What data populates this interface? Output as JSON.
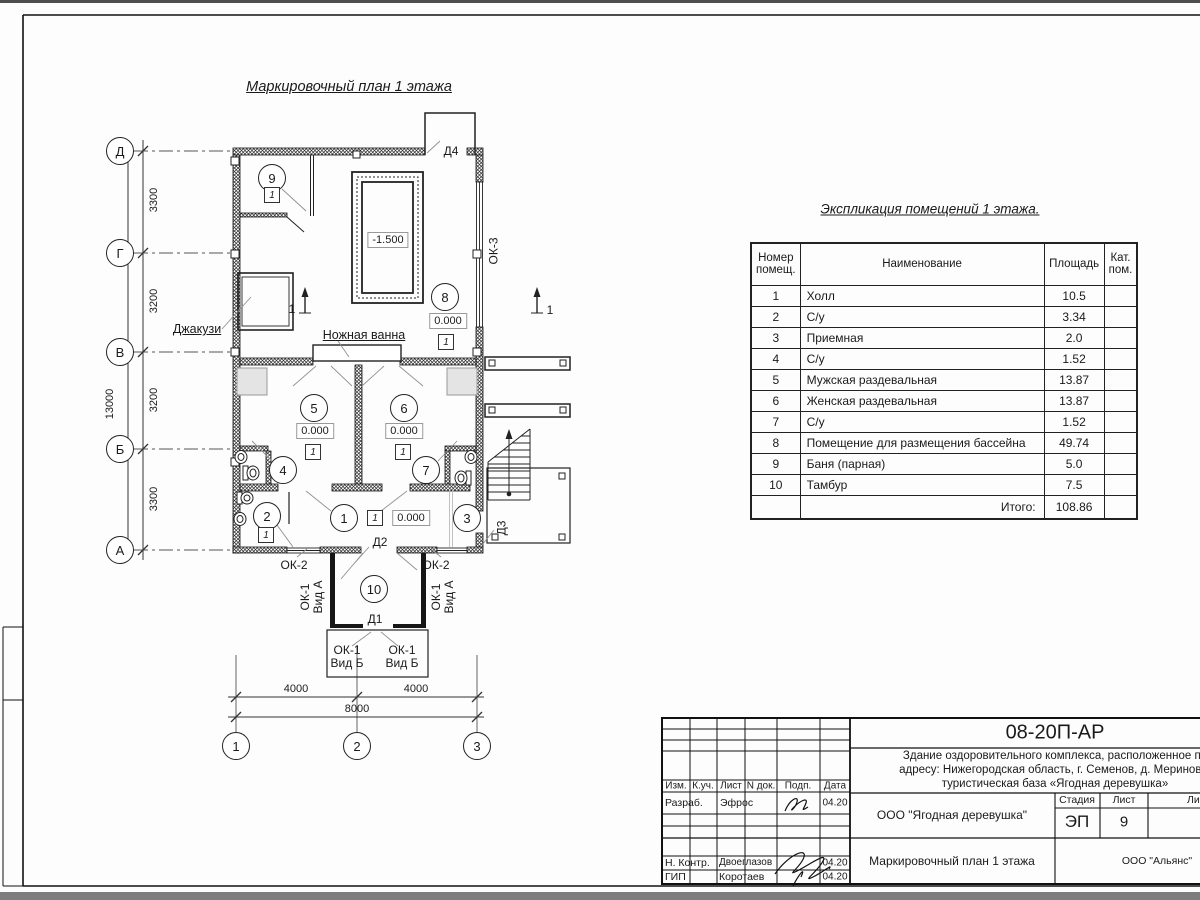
{
  "plan": {
    "title": "Маркировочный план 1 этажа",
    "axes_rows": [
      "Д",
      "Г",
      "В",
      "Б",
      "А"
    ],
    "axes_cols": [
      "1",
      "2",
      "3"
    ],
    "dims_left": [
      "3300",
      "3200",
      "3200",
      "3300"
    ],
    "dim_total_left": "13000",
    "dims_bottom": [
      "4000",
      "4000"
    ],
    "dim_total_bottom": "8000",
    "section_mark": "1",
    "rooms": [
      "1",
      "2",
      "3",
      "4",
      "5",
      "6",
      "7",
      "8",
      "9",
      "10"
    ],
    "type_marker": "1",
    "elev_zero": "0.000",
    "elev_pool": "-1.500",
    "labels": {
      "jacuzzi": "Джакузи",
      "foot_bath": "Ножная ванна",
      "ok3": "ОК-3",
      "ok2": "ОК-2",
      "ok1": "ОК-1",
      "viewA": "Вид А",
      "viewB": "Вид Б",
      "d1": "Д1",
      "d2": "Д2",
      "d3": "Д3",
      "d4": "Д4"
    }
  },
  "table": {
    "title": "Экспликация помещений 1 этажа.",
    "headers": {
      "num": "Номер помещ.",
      "name": "Наименование",
      "area": "Площадь",
      "cat": "Кат. пом."
    },
    "rows": [
      {
        "num": "1",
        "name": "Холл",
        "area": "10.5"
      },
      {
        "num": "2",
        "name": "С/у",
        "area": "3.34"
      },
      {
        "num": "3",
        "name": "Приемная",
        "area": "2.0"
      },
      {
        "num": "4",
        "name": "С/у",
        "area": "1.52"
      },
      {
        "num": "5",
        "name": "Мужская раздевальная",
        "area": "13.87"
      },
      {
        "num": "6",
        "name": "Женская раздевальная",
        "area": "13.87"
      },
      {
        "num": "7",
        "name": "С/у",
        "area": "1.52"
      },
      {
        "num": "8",
        "name": "Помещение для размещения бассейна",
        "area": "49.74"
      },
      {
        "num": "9",
        "name": "Баня (парная)",
        "area": "5.0"
      },
      {
        "num": "10",
        "name": "Тамбур",
        "area": "7.5"
      }
    ],
    "total_label": "Итого:",
    "total_value": "108.86"
  },
  "titleblock": {
    "code": "08-20П-АР",
    "desc_lines": [
      "Здание оздоровительного комплекса, расположенное по",
      "адресу: Нижегородская область, г. Семенов, д. Мериново,",
      "туристическая база «Ягодная деревушка»"
    ],
    "cols": [
      "Изм.",
      "К.уч.",
      "Лист",
      "N док.",
      "Подп.",
      "Дата"
    ],
    "rows": [
      {
        "role": "Разраб.",
        "name": "Эфрос",
        "date": "04.20"
      },
      {
        "role": "Н. Контр.",
        "name": "Двоеглазов",
        "date": "04.20"
      },
      {
        "role": "ГИП",
        "name": "Коротаев",
        "date": "04.20"
      }
    ],
    "org": "ООО \"Ягодная деревушка\"",
    "stage_label": "Стадия",
    "sheet_label": "Лист",
    "sheets_label": "Листов",
    "stage": "ЭП",
    "sheet": "9",
    "drawing_title": "Маркировочный план 1 этажа",
    "firm": "ООО \"Альянс\""
  }
}
